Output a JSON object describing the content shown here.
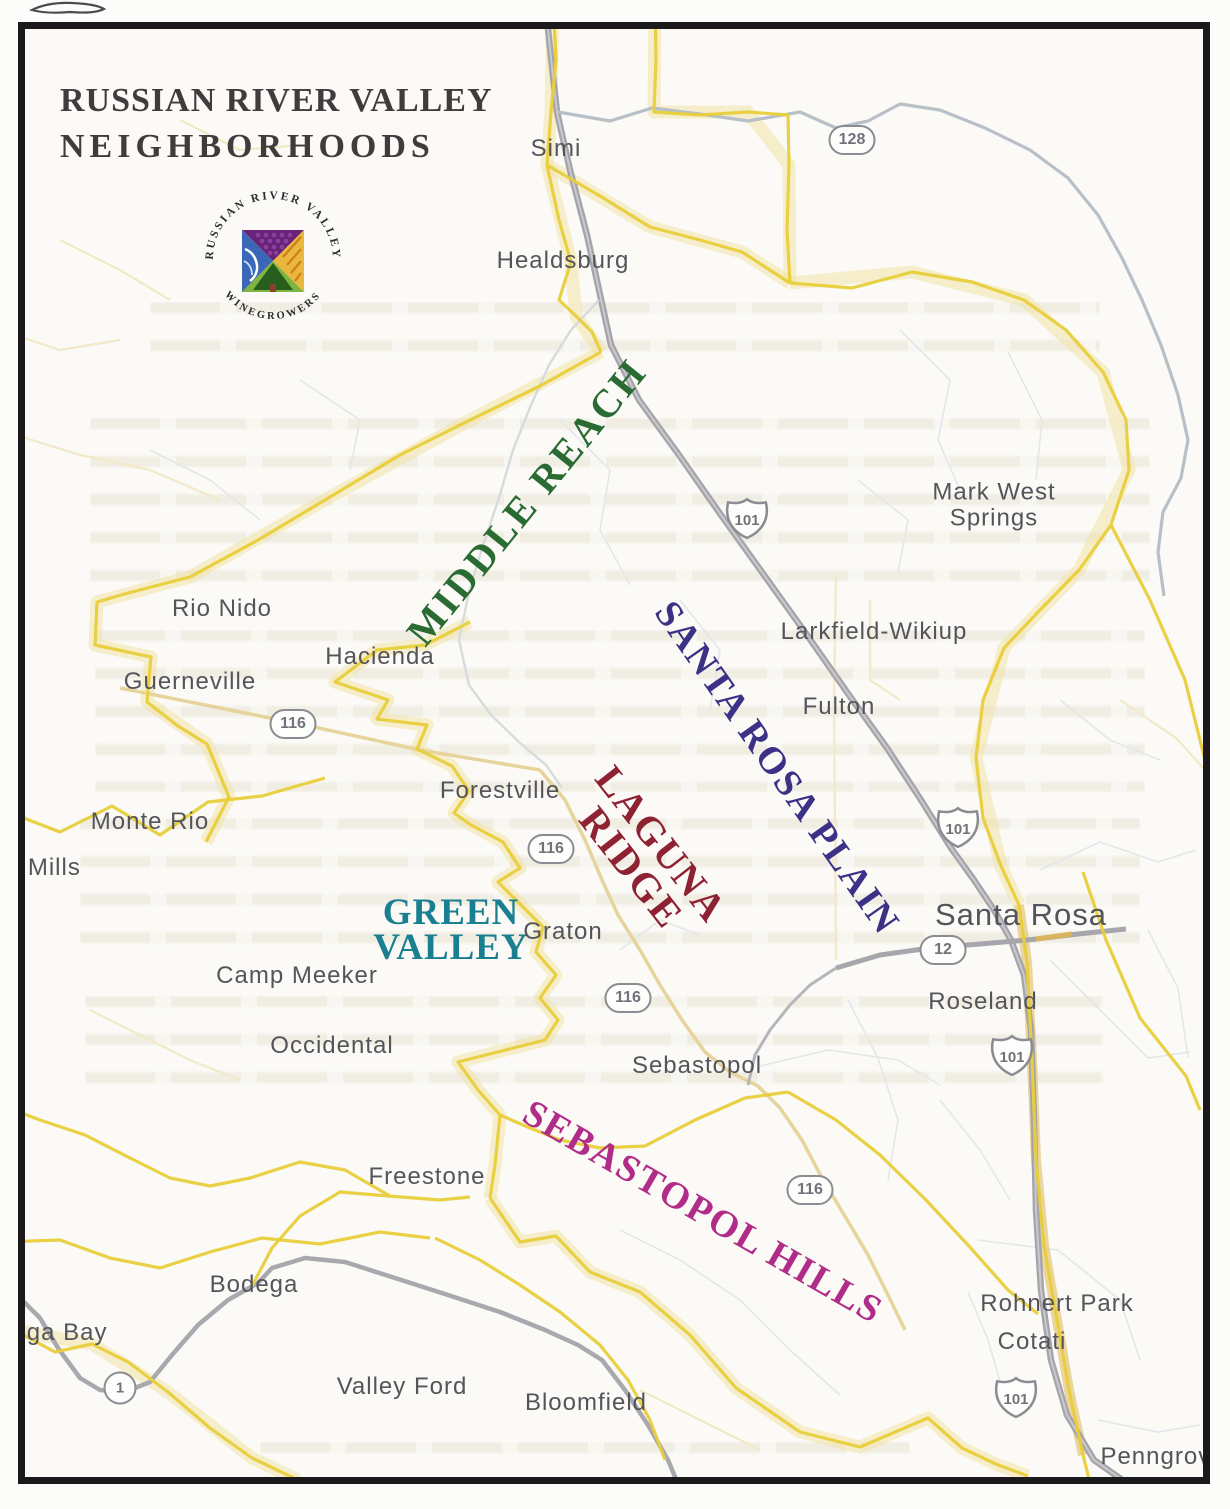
{
  "header": {
    "title_line1": "RUSSIAN RIVER VALLEY",
    "title_line2": "NEIGHBORHOODS"
  },
  "logo": {
    "arc_top_text": "RUSSIAN RIVER VALLEY",
    "arc_bottom_text": "• WINEGROWERS •",
    "quadrants": [
      "grapes-purple",
      "river-wave-blue",
      "vineyard-rows-gold",
      "tree-hill-green"
    ]
  },
  "map": {
    "regions": [
      {
        "id": "middle-reach",
        "label": "MIDDLE REACH",
        "x": 527,
        "y": 502,
        "rotate": -51,
        "color": "#2a6b33",
        "size": 40,
        "ls": 3
      },
      {
        "id": "santa-rosa-plain",
        "label": "SANTA ROSA PLAIN",
        "x": 777,
        "y": 768,
        "rotate": 55,
        "color": "#3b3187",
        "size": 38,
        "ls": 2
      },
      {
        "id": "laguna-ridge",
        "label": "LAGUNA\nRIDGE",
        "x": 646,
        "y": 856,
        "rotate": 52,
        "color": "#8e2132",
        "size": 40,
        "ls": 2
      },
      {
        "id": "green-valley",
        "label": "GREEN\nVALLEY",
        "x": 451,
        "y": 930,
        "rotate": 0,
        "color": "#1a7f90",
        "size": 37,
        "ls": 1
      },
      {
        "id": "sebastopol-hills",
        "label": "SEBASTOPOL HILLS",
        "x": 703,
        "y": 1212,
        "rotate": 30,
        "color": "#b12c88",
        "size": 38,
        "ls": 2
      }
    ],
    "cities": [
      {
        "id": "simi",
        "label": "Simi",
        "x": 556,
        "y": 149
      },
      {
        "id": "healdsburg",
        "label": "Healdsburg",
        "x": 563,
        "y": 261
      },
      {
        "id": "mark-west-springs",
        "label": "Mark West\nSprings",
        "x": 994,
        "y": 506
      },
      {
        "id": "rio-nido",
        "label": "Rio Nido",
        "x": 222,
        "y": 609
      },
      {
        "id": "larkfield-wikiup",
        "label": "Larkfield-Wikiup",
        "x": 874,
        "y": 632
      },
      {
        "id": "hacienda",
        "label": "Hacienda",
        "x": 380,
        "y": 657
      },
      {
        "id": "guerneville",
        "label": "Guerneville",
        "x": 190,
        "y": 682
      },
      {
        "id": "fulton",
        "label": "Fulton",
        "x": 839,
        "y": 707
      },
      {
        "id": "forestville",
        "label": "Forestville",
        "x": 500,
        "y": 791
      },
      {
        "id": "monte-rio",
        "label": "Monte Rio",
        "x": 150,
        "y": 822
      },
      {
        "id": "s-mills",
        "label": "s Mills",
        "x": 44,
        "y": 868
      },
      {
        "id": "santa-rosa",
        "label": "Santa Rosa",
        "x": 1021,
        "y": 915,
        "size": 31
      },
      {
        "id": "graton",
        "label": "Graton",
        "x": 563,
        "y": 932
      },
      {
        "id": "camp-meeker",
        "label": "Camp Meeker",
        "x": 297,
        "y": 976
      },
      {
        "id": "roseland",
        "label": "Roseland",
        "x": 983,
        "y": 1002
      },
      {
        "id": "occidental",
        "label": "Occidental",
        "x": 332,
        "y": 1046
      },
      {
        "id": "sebastopol",
        "label": "Sebastopol",
        "x": 697,
        "y": 1066
      },
      {
        "id": "freestone",
        "label": "Freestone",
        "x": 427,
        "y": 1177
      },
      {
        "id": "bodega",
        "label": "Bodega",
        "x": 254,
        "y": 1285
      },
      {
        "id": "bodega-bay",
        "label": "ega Bay",
        "x": 60,
        "y": 1333
      },
      {
        "id": "valley-ford",
        "label": "Valley Ford",
        "x": 402,
        "y": 1387
      },
      {
        "id": "bloomfield",
        "label": "Bloomfield",
        "x": 586,
        "y": 1403
      },
      {
        "id": "rohnert-park",
        "label": "Rohnert Park",
        "x": 1057,
        "y": 1304
      },
      {
        "id": "cotati",
        "label": "Cotati",
        "x": 1032,
        "y": 1342
      },
      {
        "id": "penngrove",
        "label": "Penngrove",
        "x": 1163,
        "y": 1457
      }
    ],
    "shields": [
      {
        "number": "128",
        "type": "oval",
        "x": 852,
        "y": 140
      },
      {
        "number": "101",
        "type": "us",
        "x": 747,
        "y": 518
      },
      {
        "number": "116",
        "type": "oval",
        "x": 293,
        "y": 724
      },
      {
        "number": "116",
        "type": "oval",
        "x": 551,
        "y": 849
      },
      {
        "number": "101",
        "type": "us",
        "x": 958,
        "y": 827
      },
      {
        "number": "12",
        "type": "oval",
        "x": 943,
        "y": 950
      },
      {
        "number": "116",
        "type": "oval",
        "x": 628,
        "y": 998
      },
      {
        "number": "101",
        "type": "us",
        "x": 1012,
        "y": 1055
      },
      {
        "number": "116",
        "type": "oval",
        "x": 810,
        "y": 1190
      },
      {
        "number": "1",
        "type": "circle",
        "x": 120,
        "y": 1388
      },
      {
        "number": "101",
        "type": "us",
        "x": 1016,
        "y": 1397
      }
    ],
    "legend_colors": {
      "ava_boundary_yellow": "#e8cd3a",
      "boundary_halo": "#f1e2a0",
      "highway_gray": "#a4a4aa",
      "minor_road_tan": "#e6d49c",
      "city_text": "#54545b",
      "title_text": "#413b3e"
    }
  }
}
